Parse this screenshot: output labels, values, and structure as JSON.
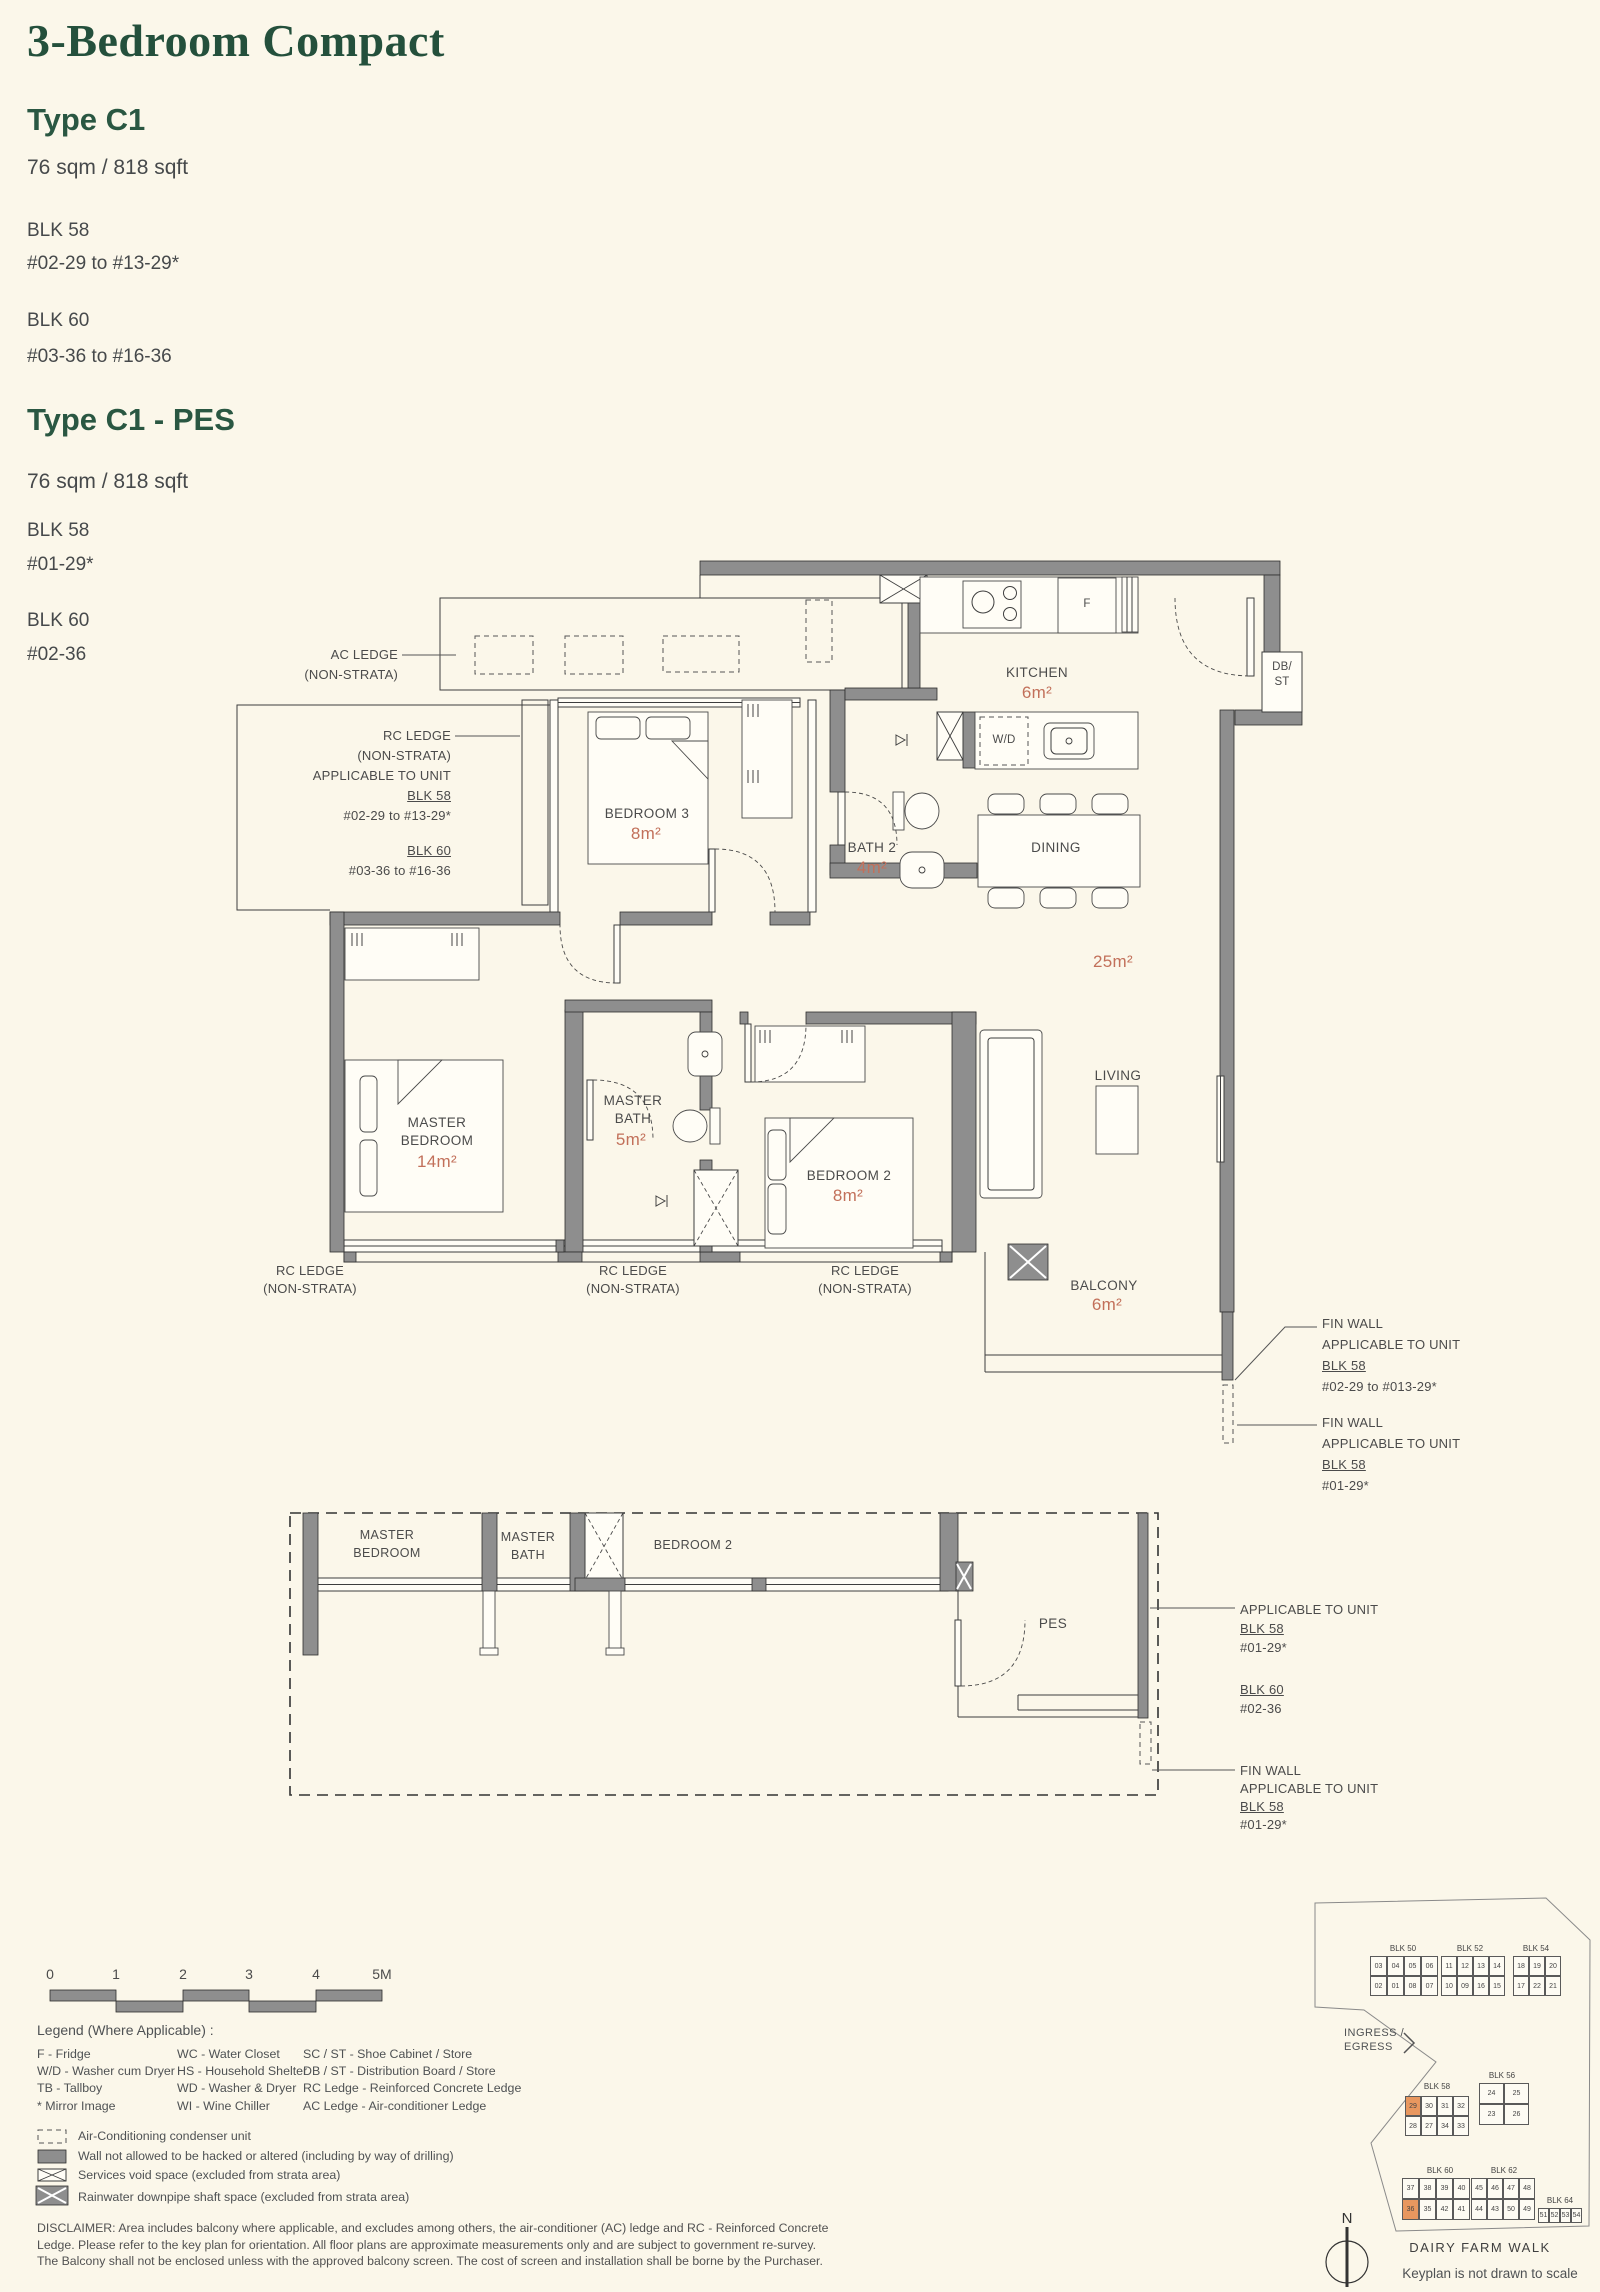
{
  "header": {
    "title": "3-Bedroom Compact",
    "type1_name": "Type C1",
    "type1_area": "76 sqm / 818 sqft",
    "type1_blk1": "BLK 58",
    "type1_blk1_units": "#02-29 to #13-29*",
    "type1_blk2": "BLK 60",
    "type1_blk2_units": "#03-36 to #16-36",
    "type2_name": "Type C1 - PES",
    "type2_area": "76 sqm / 818 sqft",
    "type2_blk1": "BLK 58",
    "type2_blk1_units": "#01-29*",
    "type2_blk2": "BLK 60",
    "type2_blk2_units": "#02-36"
  },
  "plan": {
    "rooms": {
      "kitchen": "KITCHEN",
      "kitchen_area": "6m²",
      "bath2": "BATH 2",
      "bath2_area": "4m²",
      "dining": "DINING",
      "living_dining_area": "25m²",
      "living": "LIVING",
      "bedroom3": "BEDROOM 3",
      "bedroom3_area": "8m²",
      "master_bedroom_l1": "MASTER",
      "master_bedroom_l2": "BEDROOM",
      "master_bedroom_area": "14m²",
      "master_bath_l1": "MASTER",
      "master_bath_l2": "BATH",
      "master_bath_area": "5m²",
      "bedroom2": "BEDROOM 2",
      "bedroom2_area": "8m²",
      "balcony": "BALCONY",
      "balcony_area": "6m²",
      "db_st": [
        "DB/",
        "ST"
      ],
      "wd": "W/D",
      "fridge": "F"
    },
    "annotations": {
      "ac_ledge": [
        "AC LEDGE",
        "(NON-STRATA)"
      ],
      "rc_ledge_left_lines": [
        "RC LEDGE",
        "(NON-STRATA)",
        "APPLICABLE TO UNIT"
      ],
      "rc_left_blk1": "BLK 58",
      "rc_left_blk1_units": "#02-29 to #13-29*",
      "rc_left_blk2": "BLK 60",
      "rc_left_blk2_units": "#03-36 to #16-36",
      "rc_bottom": [
        "RC LEDGE",
        "(NON-STRATA)"
      ],
      "fin1_lines": [
        "FIN WALL",
        "APPLICABLE TO UNIT"
      ],
      "fin1_blk": "BLK 58",
      "fin1_units": "#02-29 to #013-29*",
      "fin2_lines": [
        "FIN WALL",
        "APPLICABLE TO UNIT"
      ],
      "fin2_blk": "BLK 58",
      "fin2_units": "#01-29*"
    }
  },
  "pes_plan": {
    "master_bedroom": [
      "MASTER",
      "BEDROOM"
    ],
    "master_bath": [
      "MASTER",
      "BATH"
    ],
    "bedroom2": "BEDROOM 2",
    "pes": "PES",
    "app": "APPLICABLE TO UNIT",
    "app_blk1": "BLK 58",
    "app_blk1_units": "#01-29*",
    "app_blk2": "BLK 60",
    "app_blk2_units": "#02-36",
    "fin_lines": [
      "FIN WALL",
      "APPLICABLE TO UNIT"
    ],
    "fin_blk": "BLK 58",
    "fin_units": "#01-29*"
  },
  "scale": {
    "labels": [
      "0",
      "1",
      "2",
      "3",
      "4",
      "5M"
    ]
  },
  "legend": {
    "title": "Legend (Where Applicable) :",
    "col1": [
      "F - Fridge",
      "W/D - Washer cum Dryer",
      "TB - Tallboy",
      "* Mirror Image"
    ],
    "col2": [
      "WC - Water Closet",
      "HS - Household Shelter",
      "WD - Washer & Dryer",
      "WI - Wine Chiller"
    ],
    "col3": [
      "SC / ST - Shoe Cabinet / Store",
      "DB / ST - Distribution Board / Store",
      "RC Ledge - Reinforced Concrete Ledge",
      "AC Ledge - Air-conditioner Ledge"
    ],
    "symbols": [
      "Air-Conditioning condenser unit",
      "Wall not allowed to be hacked or altered (including by way of drilling)",
      "Services void space (excluded from strata area)",
      "Rainwater downpipe shaft space (excluded from strata area)"
    ]
  },
  "disclaimer": "DISCLAIMER: Area includes balcony where applicable, and excludes among others, the air-conditioner (AC) ledge and RC - Reinforced Concrete Ledge. Please refer to the key plan for orientation. All floor plans are approximate measurements only and are subject to government re-survey. The Balcony shall not be enclosed unless with the approved balcony screen. The cost of screen and installation shall be borne by the Purchaser.",
  "keyplan": {
    "blocks": [
      {
        "name": "BLK 50",
        "lx": 1403,
        "ly": 1944,
        "x": 1370,
        "y": 1956,
        "cw": 17,
        "ch": 20,
        "rows": [
          [
            "03",
            "04",
            "05",
            "06"
          ],
          [
            "02",
            "01",
            "08",
            "07"
          ]
        ],
        "hl": []
      },
      {
        "name": "BLK 52",
        "lx": 1470,
        "ly": 1944,
        "x": 1441,
        "y": 1956,
        "cw": 16,
        "ch": 20,
        "rows": [
          [
            "11",
            "12",
            "13",
            "14"
          ],
          [
            "10",
            "09",
            "16",
            "15"
          ]
        ],
        "hl": []
      },
      {
        "name": "BLK 54",
        "lx": 1536,
        "ly": 1944,
        "x": 1513,
        "y": 1956,
        "cw": 16,
        "ch": 20,
        "rows": [
          [
            "18",
            "19",
            "20"
          ],
          [
            "17",
            "22",
            "21"
          ]
        ],
        "hl": []
      },
      {
        "name": "BLK 58",
        "lx": 1437,
        "ly": 2082,
        "x": 1405,
        "y": 2096,
        "cw": 16,
        "ch": 20,
        "rows": [
          [
            "29",
            "30",
            "31",
            "32"
          ],
          [
            "28",
            "27",
            "34",
            "33"
          ]
        ],
        "hl": [
          "29"
        ]
      },
      {
        "name": "BLK 56",
        "lx": 1502,
        "ly": 2071,
        "x": 1479,
        "y": 2083,
        "cw": 25,
        "ch": 21,
        "rows": [
          [
            "24",
            "25"
          ],
          [
            "23",
            "26"
          ]
        ],
        "hl": []
      },
      {
        "name": "BLK 60",
        "lx": 1440,
        "ly": 2166,
        "x": 1402,
        "y": 2178,
        "cw": 17,
        "ch": 21,
        "rows": [
          [
            "37",
            "38",
            "39",
            "40"
          ],
          [
            "36",
            "35",
            "42",
            "41"
          ]
        ],
        "hl": [
          "36"
        ]
      },
      {
        "name": "BLK 62",
        "lx": 1504,
        "ly": 2166,
        "x": 1471,
        "y": 2178,
        "cw": 16,
        "ch": 21,
        "rows": [
          [
            "45",
            "46",
            "47",
            "48"
          ],
          [
            "44",
            "43",
            "50",
            "49"
          ]
        ],
        "hl": []
      },
      {
        "name": "BLK 64",
        "lx": 1560,
        "ly": 2196,
        "x": 1538,
        "y": 2208,
        "cw": 11,
        "ch": 15,
        "rows": [
          [
            "51",
            "52",
            "53",
            "54"
          ]
        ],
        "hl": []
      }
    ],
    "ingress_lines": [
      "INGRESS /",
      "EGRESS"
    ],
    "street": "DAIRY FARM WALK",
    "note": "Keyplan is not drawn to scale",
    "north": "N"
  }
}
